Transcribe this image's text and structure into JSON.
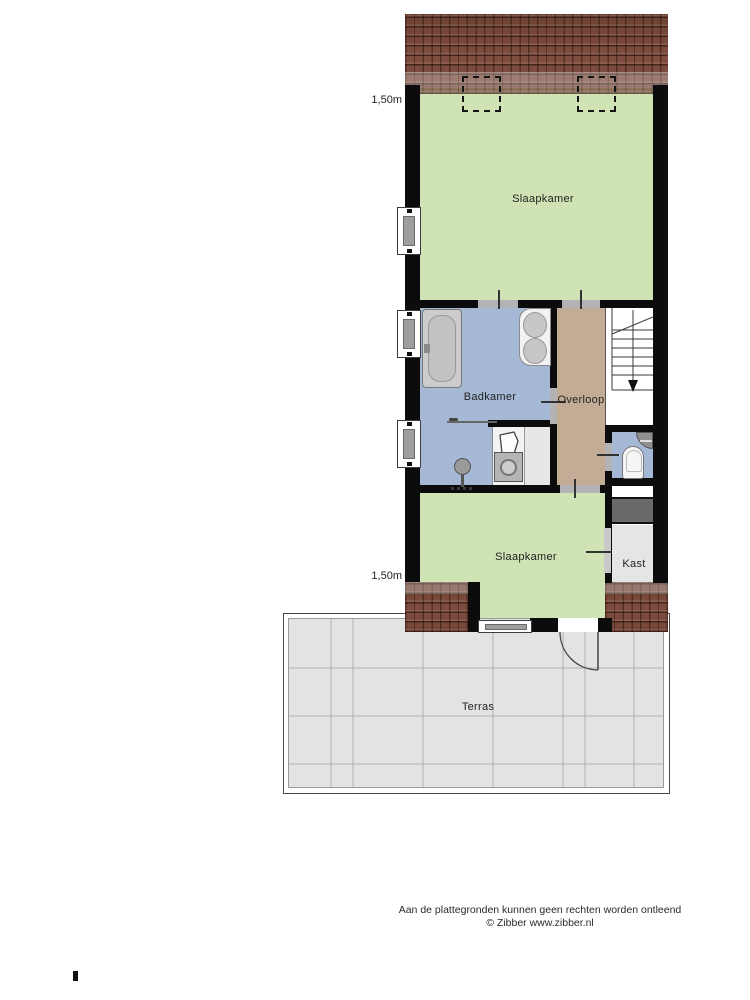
{
  "floorplan": {
    "rooms": [
      {
        "id": "slaapkamer-top",
        "name": "Slaapkamer"
      },
      {
        "id": "badkamer",
        "name": "Badkamer"
      },
      {
        "id": "overloop",
        "name": "Overloop"
      },
      {
        "id": "slaapkamer-bottom",
        "name": "Slaapkamer"
      },
      {
        "id": "kast",
        "name": "Kast"
      },
      {
        "id": "terras",
        "name": "Terras"
      }
    ],
    "dimensions": {
      "top": "1,50m",
      "bottom": "1,50m"
    },
    "fixtures": [
      "bathtub",
      "double-sink",
      "shower-head",
      "shower-screen",
      "laundry-sink",
      "washing-machine",
      "toilet",
      "corner-sink",
      "staircase-down",
      "dormer-window",
      "dormer-window",
      "terrace-door"
    ]
  },
  "footer": {
    "line1": "Aan de plattegronden kunnen geen rechten worden ontleend",
    "line2": "© Zibber www.zibber.nl"
  },
  "colors": {
    "wall": "#0c0c0c",
    "bedroom_green": "#cfe3b4",
    "bathroom_blue": "#a5b9d6",
    "landing_tan": "#c3ac96",
    "terrace_gray": "#e3e3e3",
    "roof_brown": "#7b4b3c",
    "void_gray": "#696969",
    "closet_gray": "#e5e5e5",
    "threshold_gray": "#b3b3b3"
  }
}
